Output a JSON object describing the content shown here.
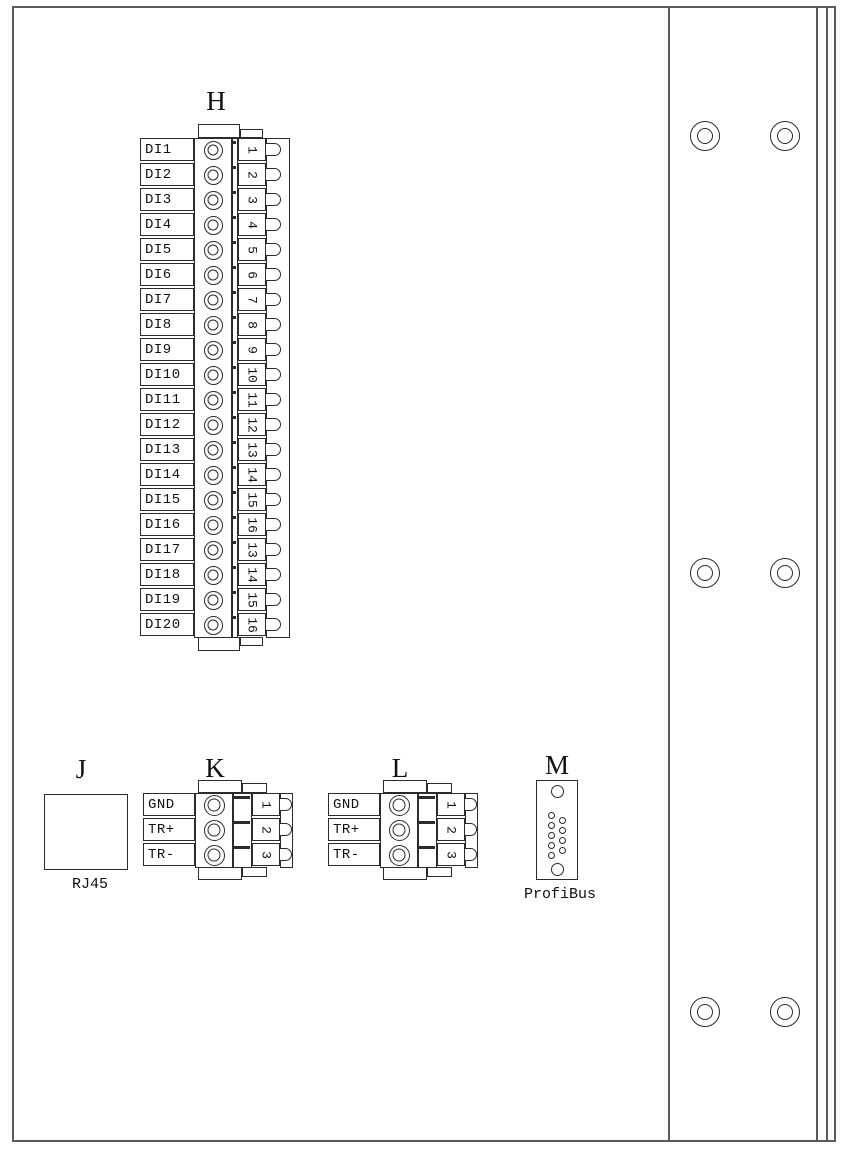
{
  "page": {
    "background": "#ffffff",
    "line_color": "#2b2b2b",
    "frame_color": "#5a5a5a"
  },
  "connectors": {
    "H": {
      "letter": "H",
      "rows": [
        {
          "name": "DI1",
          "pin": "1"
        },
        {
          "name": "DI2",
          "pin": "2"
        },
        {
          "name": "DI3",
          "pin": "3"
        },
        {
          "name": "DI4",
          "pin": "4"
        },
        {
          "name": "DI5",
          "pin": "5"
        },
        {
          "name": "DI6",
          "pin": "6"
        },
        {
          "name": "DI7",
          "pin": "7"
        },
        {
          "name": "DI8",
          "pin": "8"
        },
        {
          "name": "DI9",
          "pin": "9"
        },
        {
          "name": "DI10",
          "pin": "10"
        },
        {
          "name": "DI11",
          "pin": "11"
        },
        {
          "name": "DI12",
          "pin": "12"
        },
        {
          "name": "DI13",
          "pin": "13"
        },
        {
          "name": "DI14",
          "pin": "14"
        },
        {
          "name": "DI15",
          "pin": "15"
        },
        {
          "name": "DI16",
          "pin": "16"
        },
        {
          "name": "DI17",
          "pin": "13"
        },
        {
          "name": "DI18",
          "pin": "14"
        },
        {
          "name": "DI19",
          "pin": "15"
        },
        {
          "name": "DI20",
          "pin": "16"
        }
      ]
    },
    "J": {
      "letter": "J",
      "caption": "RJ45"
    },
    "K": {
      "letter": "K",
      "rows": [
        {
          "name": "GND",
          "pin": "1"
        },
        {
          "name": "TR+",
          "pin": "2"
        },
        {
          "name": "TR-",
          "pin": "3"
        }
      ]
    },
    "L": {
      "letter": "L",
      "rows": [
        {
          "name": "GND",
          "pin": "1"
        },
        {
          "name": "TR+",
          "pin": "2"
        },
        {
          "name": "TR-",
          "pin": "3"
        }
      ]
    },
    "M": {
      "letter": "M",
      "caption": "ProfiBus",
      "pin_count": 9,
      "screw_holes": 2
    }
  },
  "panel": {
    "mount_hole_pairs": 3,
    "holes_per_row": 2
  }
}
